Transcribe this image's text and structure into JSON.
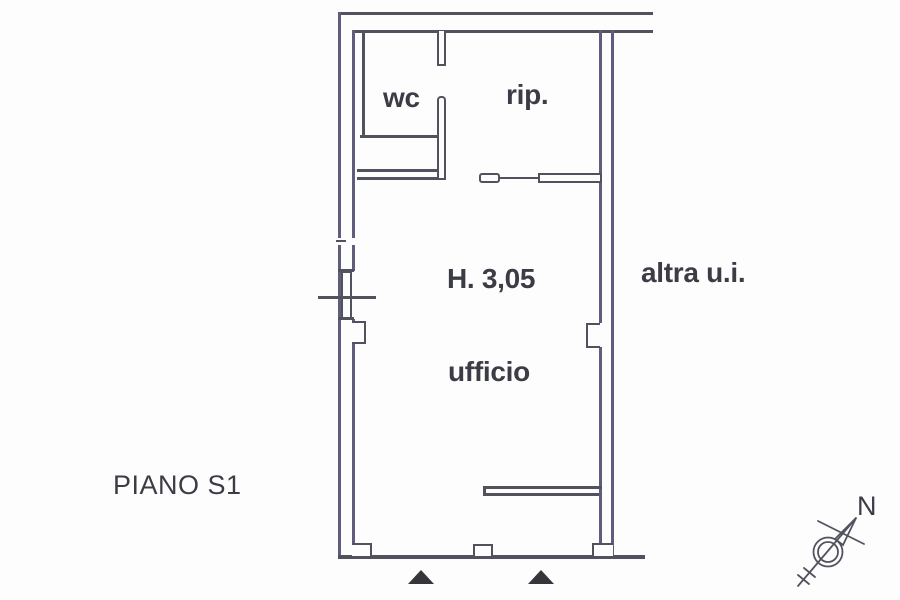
{
  "document": {
    "type": "scanned-floor-plan",
    "floor_label": "PIANO S1"
  },
  "rooms": {
    "wc": {
      "label": "wc"
    },
    "rip": {
      "label": "rip."
    },
    "ufficio": {
      "label": "ufficio"
    }
  },
  "annotations": {
    "ceiling_height": "H. 3,05",
    "adjacent_unit": "altra u.i.",
    "floor": "PIANO S1",
    "north": "N"
  },
  "icons": {
    "compass": "north-compass-arrow",
    "entrance_markers": "entrance-triangle"
  },
  "colors": {
    "background": "#fdfdfd",
    "wall_line": "#52525e",
    "wall_line_tint": "#5e5e7c",
    "text": "#3c3c47",
    "entrance_marker": "#35353b"
  }
}
